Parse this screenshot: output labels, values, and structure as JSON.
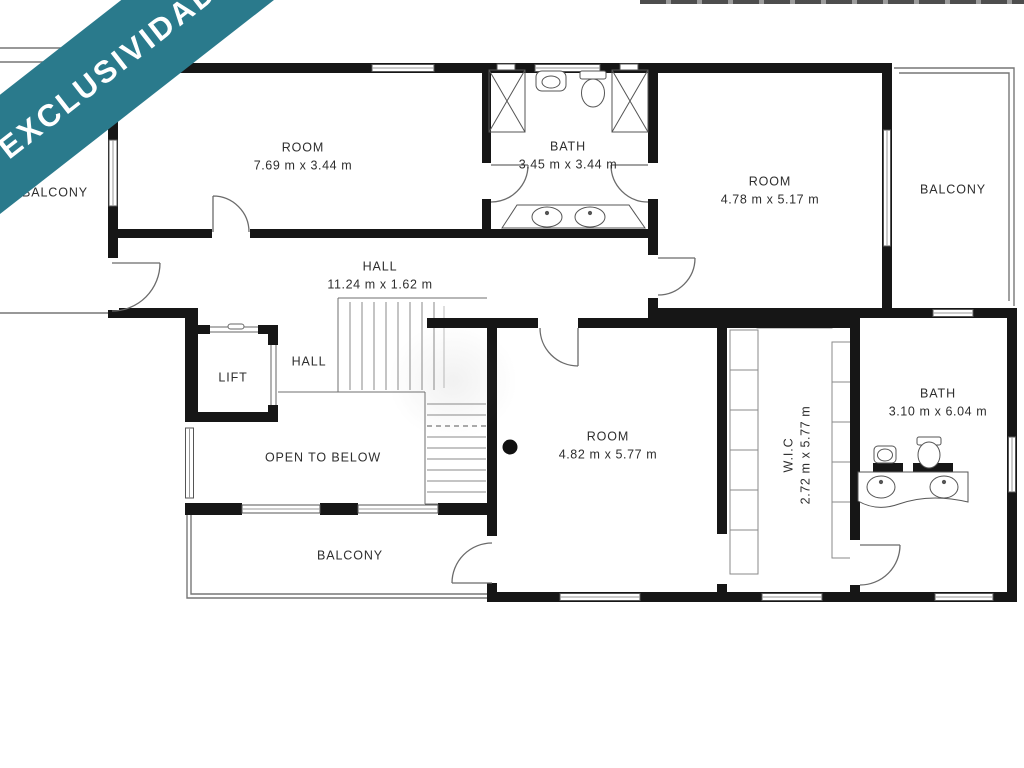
{
  "banner": {
    "text": "EXCLUSIVIDAD",
    "color": "#2a7a8c"
  },
  "rooms": {
    "room_top_left": {
      "name": "ROOM",
      "dims": "7.69 m x 3.44 m"
    },
    "bath_top": {
      "name": "BATH",
      "dims": "3.45 m x 3.44 m"
    },
    "room_top_right": {
      "name": "ROOM",
      "dims": "4.78 m x 5.17 m"
    },
    "balcony_right": {
      "name": "BALCONY"
    },
    "balcony_left": {
      "name": "BALCONY"
    },
    "hall_main": {
      "name": "HALL",
      "dims": "11.24 m x 1.62 m"
    },
    "hall_small": {
      "name": "HALL"
    },
    "lift": {
      "name": "LIFT"
    },
    "open_to_below": {
      "name": "OPEN TO BELOW"
    },
    "room_center": {
      "name": "ROOM",
      "dims": "4.82 m x 5.77 m"
    },
    "wic": {
      "name": "W.I.C",
      "dims": "2.72 m x 5.77 m"
    },
    "bath_right": {
      "name": "BATH",
      "dims": "3.10 m x 6.04 m"
    },
    "balcony_bottom": {
      "name": "BALCONY"
    }
  }
}
